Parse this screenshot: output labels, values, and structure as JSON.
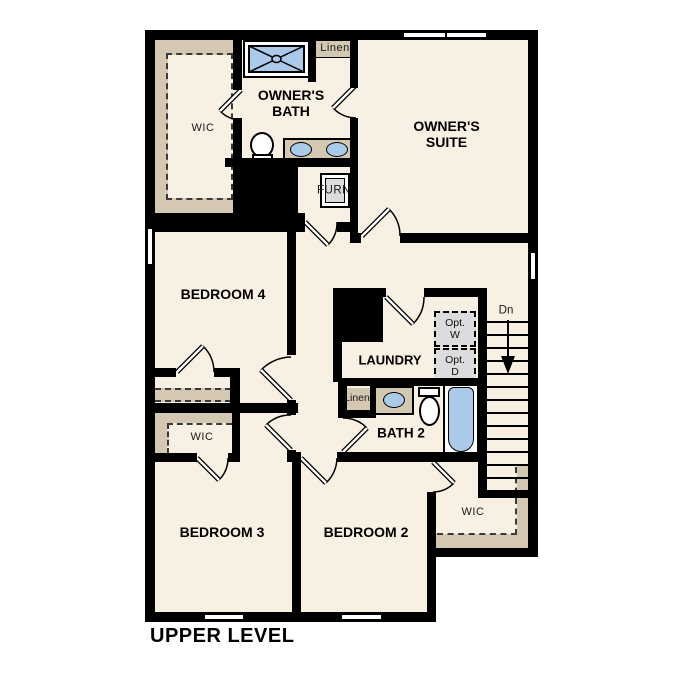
{
  "title": "UPPER LEVEL",
  "rooms": {
    "owners_suite": "OWNER'S SUITE",
    "owners_bath": "OWNER'S BATH",
    "bedroom4": "BEDROOM 4",
    "bedroom3": "BEDROOM 3",
    "bedroom2": "BEDROOM 2",
    "laundry": "LAUNDRY",
    "bath2": "BATH 2"
  },
  "closets": {
    "owners_wic": "WIC",
    "bedroom3_wic": "WIC",
    "bedroom2_wic": "WIC",
    "linen_hall": "Linen",
    "linen_bath": "Linen"
  },
  "features": {
    "furnace": "FURN",
    "stairs_direction": "Dn",
    "optional_washer": "Opt. W",
    "optional_dryer": "Opt. D"
  },
  "colors": {
    "wall": "#000000",
    "floor": "#f8f0e2",
    "tan": "#d5c8b2",
    "fixture_blue": "#abc9e8",
    "appliance_gray": "#dcdcdc",
    "outside": "#ffffff"
  }
}
